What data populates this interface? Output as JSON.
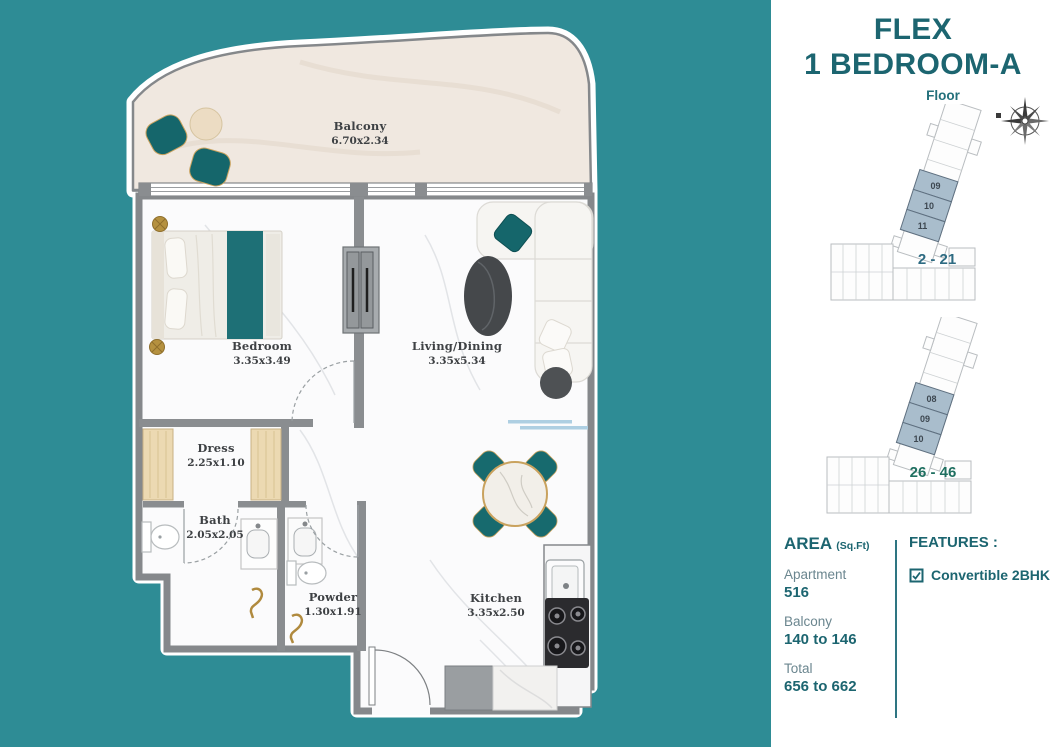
{
  "colors": {
    "background": "#2E8C95",
    "panel": "#FFFFFF",
    "heading_teal": "#1C6570",
    "muted_label": "#6B868F",
    "divider": "#2E7582",
    "wall_gray": "#8A8D90",
    "balcony_floor": "#F0E8E0",
    "interior_floor": "#FBFBFC",
    "furniture_teal": "#15666B",
    "wood_tan": "#ECD9B2",
    "gold_accent": "#B08A3E",
    "unit_highlight": "#A9BDCC"
  },
  "header": {
    "title_line1": "FLEX",
    "title_line2": "1 BEDROOM-A"
  },
  "floor_section": {
    "label": "Floor",
    "diagrams": [
      {
        "units": [
          "09",
          "10",
          "11"
        ],
        "range": "2 - 21",
        "range_color": "#2E6B82"
      },
      {
        "units": [
          "08",
          "09",
          "10"
        ],
        "range": "26 - 46",
        "range_color": "#1F6F60"
      }
    ]
  },
  "area_section": {
    "heading": "AREA",
    "unit_label": "(Sq.Ft)",
    "rows": [
      {
        "label": "Apartment",
        "value": "516"
      },
      {
        "label": "Balcony",
        "value": "140 to 146"
      },
      {
        "label": "Total",
        "value": "656 to 662"
      }
    ]
  },
  "features_section": {
    "heading": "FEATURES :",
    "items": [
      {
        "checked": true,
        "label": "Convertible 2BHK"
      }
    ]
  },
  "floorplan": {
    "rooms": [
      {
        "name": "Balcony",
        "dims": "6.70x2.34"
      },
      {
        "name": "Bedroom",
        "dims": "3.35x3.49"
      },
      {
        "name": "Living/Dining",
        "dims": "3.35x5.34"
      },
      {
        "name": "Dress",
        "dims": "2.25x1.10"
      },
      {
        "name": "Bath",
        "dims": "2.05x2.05"
      },
      {
        "name": "Powder",
        "dims": "1.30x1.91"
      },
      {
        "name": "Kitchen",
        "dims": "3.35x2.50"
      }
    ]
  }
}
